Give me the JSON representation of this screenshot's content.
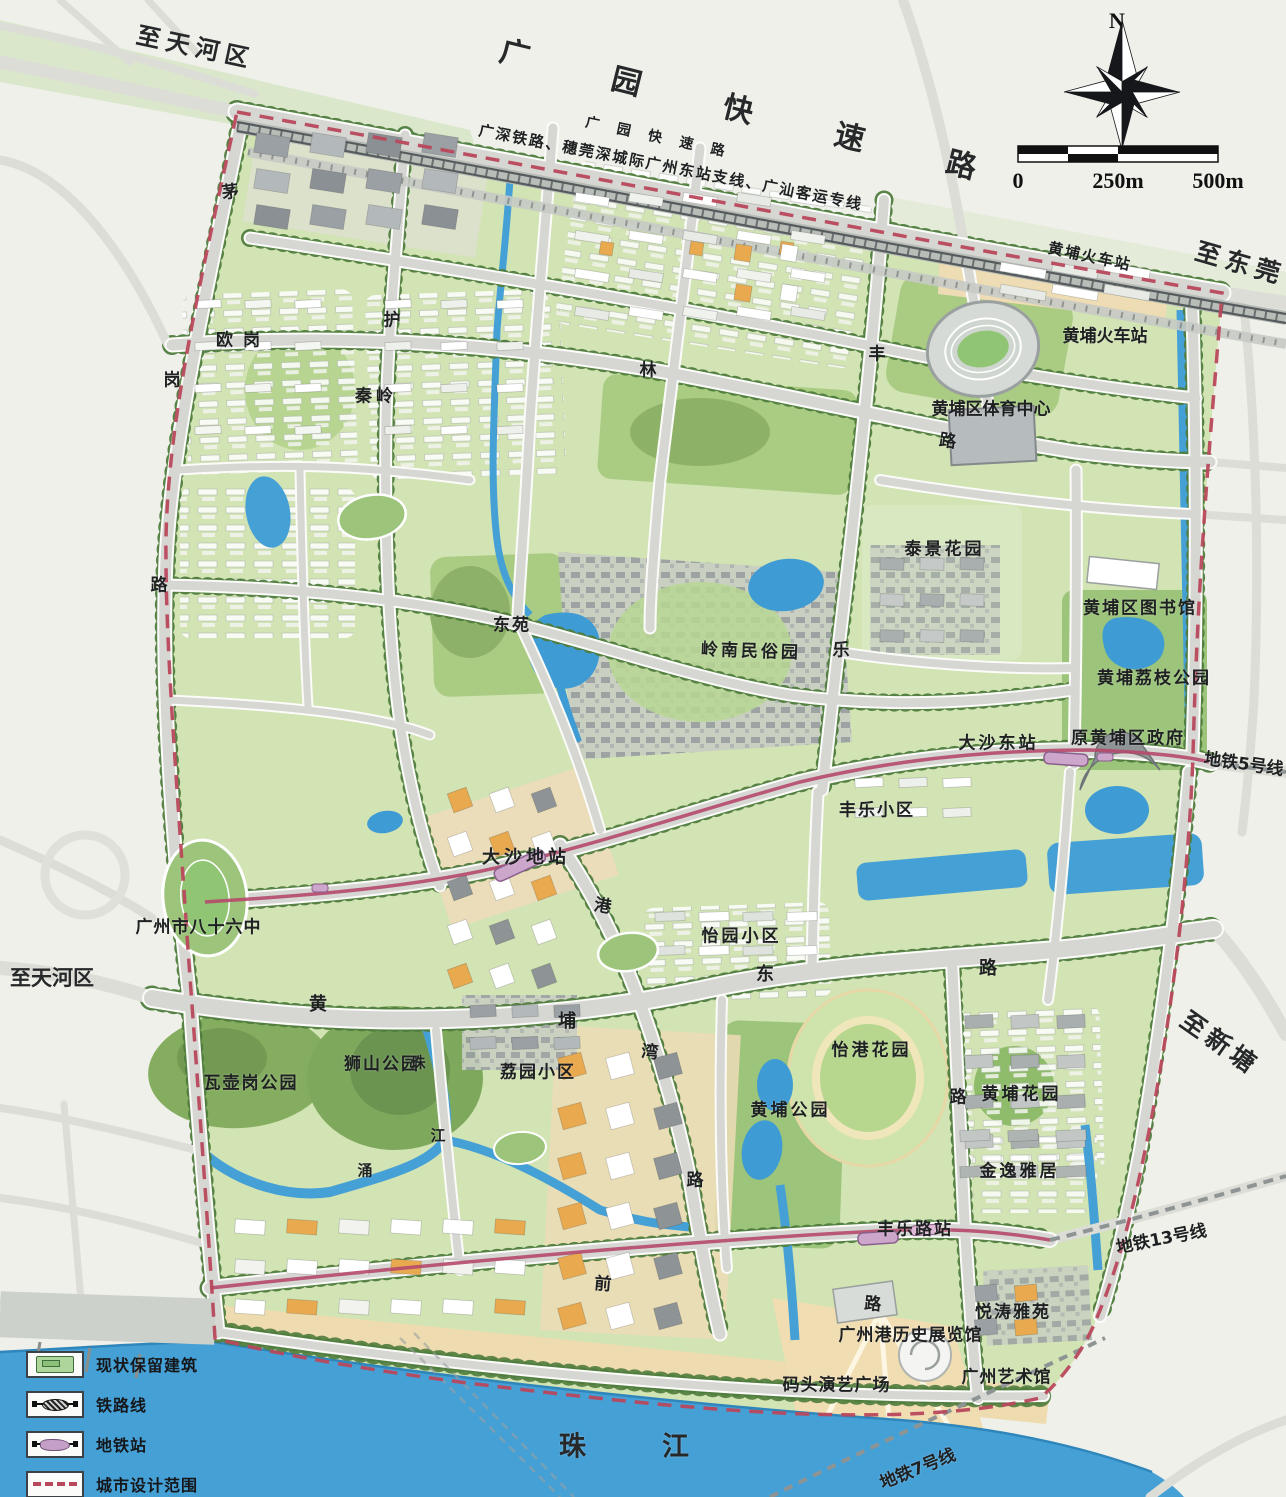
{
  "map": {
    "title": "黄埔城市设计总平面图",
    "labels": [
      {
        "name": "to-tianhe-top",
        "text": "至天河区",
        "x": 193,
        "y": 45,
        "size": 24,
        "rot": 12,
        "ls": 6,
        "bold": true
      },
      {
        "name": "guangyuan-expressway",
        "text": "广园快速路",
        "x": 737,
        "y": 117,
        "size": 30,
        "rot": 14,
        "ls": 85,
        "bold": true
      },
      {
        "name": "guangyuan-road-small",
        "text": "广园快速路",
        "x": 655,
        "y": 138,
        "size": 14,
        "rot": 12,
        "ls": 18
      },
      {
        "name": "railway-line-label",
        "text": "广深铁路、穗莞深城际广州东站支线、广汕客运专线",
        "x": 670,
        "y": 167,
        "size": 15,
        "rot": 11,
        "ls": 2
      },
      {
        "name": "huangpu-rail-station-small",
        "text": "黄埔火车站",
        "x": 1089,
        "y": 256,
        "size": 15,
        "rot": 12,
        "ls": 2
      },
      {
        "name": "to-dongguan",
        "text": "至东莞",
        "x": 1238,
        "y": 262,
        "size": 25,
        "rot": 16,
        "ls": 6,
        "bold": true
      },
      {
        "name": "huangpu-railway-station",
        "text": "黄埔火车站",
        "x": 1105,
        "y": 334,
        "size": 17
      },
      {
        "name": "sports-center",
        "text": "黄埔区体育中心",
        "x": 991,
        "y": 407,
        "size": 17
      },
      {
        "name": "ougang",
        "text": "欧岗",
        "x": 238,
        "y": 338,
        "size": 17,
        "ls": 10
      },
      {
        "name": "qinling",
        "text": "秦岭",
        "x": 374,
        "y": 394,
        "size": 17,
        "ls": 4
      },
      {
        "name": "dongyuan",
        "text": "东苑",
        "x": 511,
        "y": 623,
        "size": 17,
        "ls": 2
      },
      {
        "name": "lingnan-folk-park",
        "text": "岭南民俗园",
        "x": 749,
        "y": 649,
        "size": 17,
        "ls": 3,
        "rot": 2
      },
      {
        "name": "taijing-garden",
        "text": "泰景花园",
        "x": 943,
        "y": 547,
        "size": 17,
        "ls": 3
      },
      {
        "name": "huangpu-library",
        "text": "黄埔区图书馆",
        "x": 1139,
        "y": 606,
        "size": 17,
        "ls": 2
      },
      {
        "name": "huangpu-lychee-park",
        "text": "黄埔荔枝公园",
        "x": 1153,
        "y": 676,
        "size": 17,
        "ls": 2
      },
      {
        "name": "dashadong-station",
        "text": "大沙东站",
        "x": 997,
        "y": 741,
        "size": 17,
        "ls": 3
      },
      {
        "name": "former-huangpu-government",
        "text": "原黄埔区政府",
        "x": 1127,
        "y": 736,
        "size": 17,
        "ls": 2
      },
      {
        "name": "metro-line5-label",
        "text": "地铁5号线",
        "x": 1244,
        "y": 762,
        "size": 17,
        "rot": 8
      },
      {
        "name": "fengle-community",
        "text": "丰乐小区",
        "x": 876,
        "y": 808,
        "size": 17,
        "ls": 2
      },
      {
        "name": "dashadi-station",
        "text": "大沙地站",
        "x": 524,
        "y": 856,
        "size": 18,
        "ls": 4
      },
      {
        "name": "yiyuan-community",
        "text": "怡园小区",
        "x": 740,
        "y": 934,
        "size": 17,
        "ls": 3
      },
      {
        "name": "no86-middle-school",
        "text": "广州市八十六中",
        "x": 198,
        "y": 925,
        "size": 17,
        "ls": 1
      },
      {
        "name": "to-tianhe-left",
        "text": "至天河区",
        "x": 52,
        "y": 977,
        "size": 21,
        "bold": true
      },
      {
        "name": "wahugang-park",
        "text": "瓦壶岗公园",
        "x": 250,
        "y": 1081,
        "size": 17,
        "ls": 2
      },
      {
        "name": "shishan-park",
        "text": "狮山公园",
        "x": 381,
        "y": 1062,
        "size": 17,
        "ls": 2
      },
      {
        "name": "liyuan-community",
        "text": "荔园小区",
        "x": 537,
        "y": 1070,
        "size": 17,
        "ls": 2
      },
      {
        "name": "yigang-garden",
        "text": "怡港花园",
        "x": 870,
        "y": 1048,
        "size": 17,
        "ls": 3
      },
      {
        "name": "huangpu-park",
        "text": "黄埔公园",
        "x": 789,
        "y": 1108,
        "size": 17,
        "ls": 3
      },
      {
        "name": "huangpu-garden",
        "text": "黄埔花园",
        "x": 1020,
        "y": 1092,
        "size": 17,
        "ls": 3
      },
      {
        "name": "jinyi-residence",
        "text": "金逸雅居",
        "x": 1018,
        "y": 1169,
        "size": 17,
        "ls": 3
      },
      {
        "name": "fenglelu-station",
        "text": "丰乐路站",
        "x": 914,
        "y": 1227,
        "size": 17,
        "ls": 2
      },
      {
        "name": "metro-line13-label",
        "text": "地铁13号线",
        "x": 1161,
        "y": 1237,
        "size": 17,
        "rot": -11
      },
      {
        "name": "yuetao-mansion",
        "text": "悦涛雅苑",
        "x": 1012,
        "y": 1310,
        "size": 17,
        "ls": 2
      },
      {
        "name": "port-history-museum",
        "text": "广州港历史展览馆",
        "x": 910,
        "y": 1333,
        "size": 17,
        "ls": 1
      },
      {
        "name": "gz-art-museum",
        "text": "广州艺术馆",
        "x": 1006,
        "y": 1375,
        "size": 17,
        "ls": 1
      },
      {
        "name": "wharf-performance-plaza",
        "text": "码头演艺广场",
        "x": 836,
        "y": 1383,
        "size": 17,
        "ls": 1
      },
      {
        "name": "zhujiang-river",
        "text": "珠江",
        "x": 624,
        "y": 1444,
        "size": 27,
        "ls": 76,
        "bold": true
      },
      {
        "name": "metro-line7-label",
        "text": "地铁7号线",
        "x": 917,
        "y": 1467,
        "size": 17,
        "rot": -22
      },
      {
        "name": "to-xintang",
        "text": "至新塘",
        "x": 1218,
        "y": 1042,
        "size": 25,
        "rot": 35,
        "ls": 5,
        "bold": true
      },
      {
        "name": "road-char-mao",
        "text": "茅",
        "x": 230,
        "y": 190,
        "size": 17,
        "rot": -8
      },
      {
        "name": "road-char-gang-west",
        "text": "岗",
        "x": 172,
        "y": 378,
        "size": 17
      },
      {
        "name": "road-char-lu-west",
        "text": "路",
        "x": 159,
        "y": 583,
        "size": 17
      },
      {
        "name": "road-char-hu",
        "text": "护",
        "x": 392,
        "y": 318,
        "size": 17
      },
      {
        "name": "road-char-lin",
        "text": "林",
        "x": 648,
        "y": 368,
        "size": 17
      },
      {
        "name": "road-char-lu-north",
        "text": "路",
        "x": 948,
        "y": 439,
        "size": 17,
        "rot": 8
      },
      {
        "name": "road-char-feng",
        "text": "丰",
        "x": 877,
        "y": 352,
        "size": 17
      },
      {
        "name": "road-char-le",
        "text": "乐",
        "x": 841,
        "y": 648,
        "size": 17
      },
      {
        "name": "road-char-huang",
        "text": "黄",
        "x": 318,
        "y": 1003,
        "size": 18
      },
      {
        "name": "road-char-pu",
        "text": "埔",
        "x": 567,
        "y": 1020,
        "size": 18
      },
      {
        "name": "road-char-dong",
        "text": "东",
        "x": 765,
        "y": 973,
        "size": 18
      },
      {
        "name": "road-char-lu-east",
        "text": "路",
        "x": 988,
        "y": 967,
        "size": 18
      },
      {
        "name": "road-char-gang-wan1",
        "text": "港",
        "x": 603,
        "y": 904,
        "size": 17,
        "rot": 10
      },
      {
        "name": "road-char-wan",
        "text": "湾",
        "x": 650,
        "y": 1050,
        "size": 17,
        "rot": 5
      },
      {
        "name": "road-char-lu-gangwan",
        "text": "路",
        "x": 695,
        "y": 1178,
        "size": 17
      },
      {
        "name": "road-char-lu-south",
        "text": "路",
        "x": 958,
        "y": 1095,
        "size": 17
      },
      {
        "name": "creek-char-zhu",
        "text": "珠",
        "x": 418,
        "y": 1062,
        "size": 15
      },
      {
        "name": "creek-char-jiang",
        "text": "江",
        "x": 438,
        "y": 1135,
        "size": 15
      },
      {
        "name": "creek-char-chong",
        "text": "涌",
        "x": 365,
        "y": 1170,
        "size": 15
      },
      {
        "name": "road-char-qian",
        "text": "前",
        "x": 603,
        "y": 1282,
        "size": 17,
        "rot": 5
      },
      {
        "name": "road-char-lu-qian",
        "text": "路",
        "x": 873,
        "y": 1302,
        "size": 17,
        "rot": 5
      }
    ]
  },
  "legend": {
    "items": [
      {
        "name": "legend-preserved-building",
        "icon": "preserved-building-icon",
        "label": "现状保留建筑"
      },
      {
        "name": "legend-railway-line",
        "icon": "railway-line-icon",
        "label": "铁路线"
      },
      {
        "name": "legend-metro-station",
        "icon": "metro-station-icon",
        "label": "地铁站"
      },
      {
        "name": "legend-design-scope",
        "icon": "design-scope-icon",
        "label": "城市设计范围"
      }
    ]
  },
  "scalebar": {
    "ticks": [
      "0",
      "250m",
      "500m"
    ]
  },
  "compass": {
    "north": "N"
  },
  "colors": {
    "boundary_red": "#b9485c",
    "water_blue": "#45a0d6",
    "metro_line": "#b5496b",
    "metro_station_fill": "#cda6cb",
    "area_green": "#d2e3b4",
    "park_green": "#8fbc6a",
    "road_gray": "#d6d7d2",
    "building_orange": "#e8a94f",
    "railway_dark": "#565b5e",
    "plaza_tan": "#eedcb4",
    "label_ink": "#1e2022"
  }
}
